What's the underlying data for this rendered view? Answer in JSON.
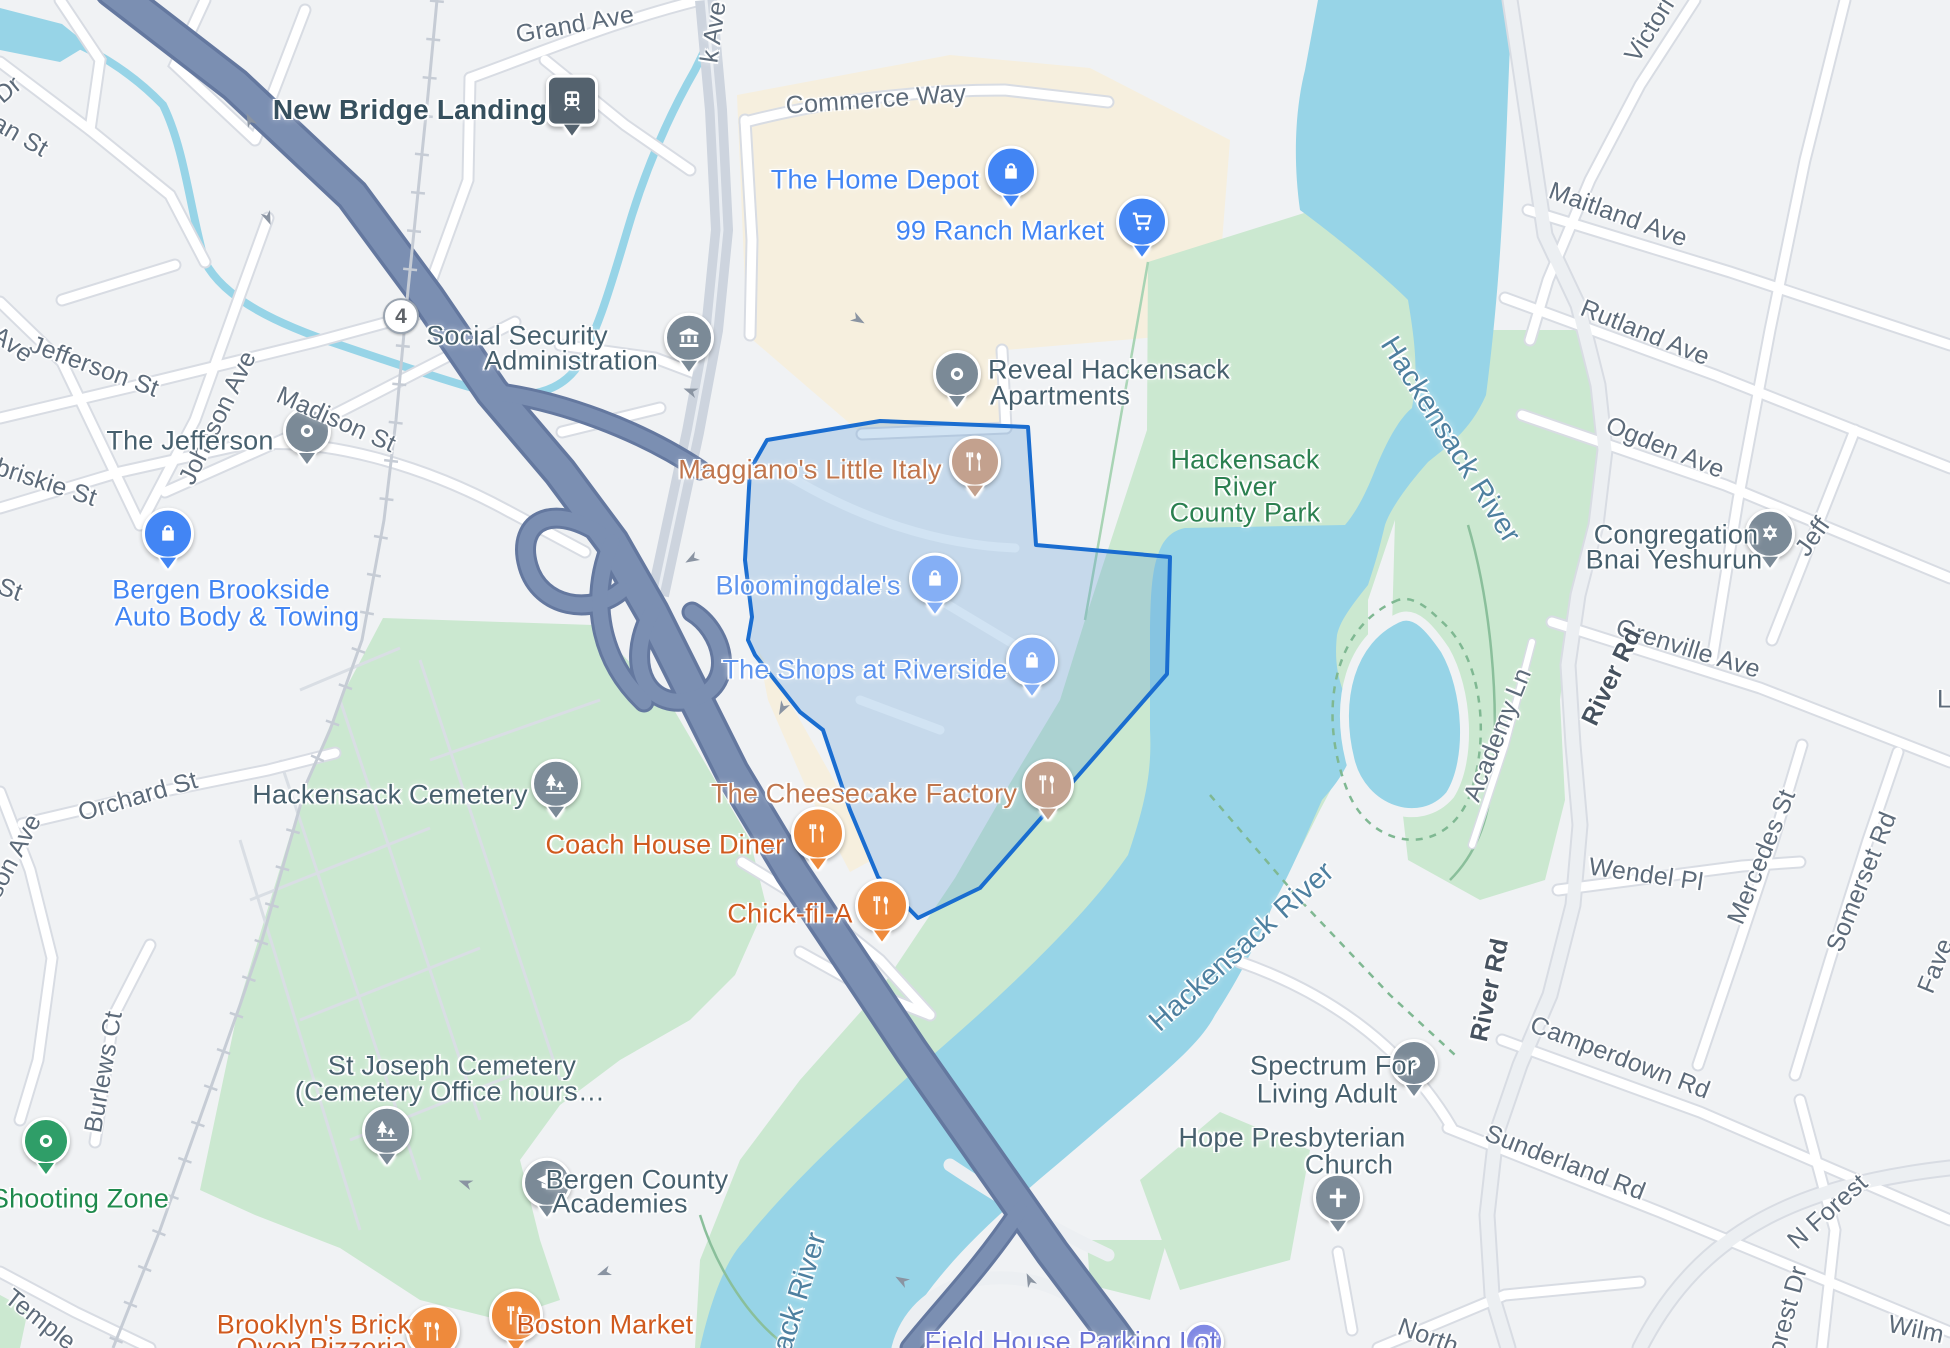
{
  "map_title": "Hackensack NJ area map with The Shops at Riverside region highlighted",
  "colors": {
    "land": "#f0f2f4",
    "commercial": "#f6efde",
    "park": "#cbe8d0",
    "water": "#97d4e7",
    "highway": "#7b8fb2",
    "highway_casing": "#64789f",
    "road_fill": "#ffffff",
    "road_casing": "#d8dce3",
    "selection_stroke": "#1a6dd0",
    "selection_fill": "rgba(91,155,213,0.28)",
    "shop_label": "#4285f4",
    "food_label": "#d05a1e",
    "park_label": "#2b8050",
    "water_label": "#4e80a0",
    "poi_label": "#47606e",
    "street_label": "#5d6b7a"
  },
  "labels": [
    {
      "name": "label-grand-ave",
      "text": "Grand Ave",
      "x": 575,
      "y": 25,
      "rot": -10,
      "cls": "street",
      "inter": false
    },
    {
      "name": "label-k-ave",
      "text": "k Ave",
      "x": 714,
      "y": 32,
      "rot": -82,
      "cls": "street",
      "inter": false
    },
    {
      "name": "label-commerce-way",
      "text": "Commerce Way",
      "x": 876,
      "y": 100,
      "rot": -4,
      "cls": "street",
      "inter": false
    },
    {
      "name": "label-dr-fragment",
      "text": "Dr",
      "x": 8,
      "y": 90,
      "rot": -40,
      "cls": "street",
      "inter": false
    },
    {
      "name": "label-an-st-fragment",
      "text": "an St",
      "x": 20,
      "y": 136,
      "rot": 30,
      "cls": "street",
      "inter": false
    },
    {
      "name": "label-madison-st",
      "text": "Madison St",
      "x": 336,
      "y": 420,
      "rot": 24,
      "cls": "street",
      "inter": false
    },
    {
      "name": "label-johnson-ave",
      "text": "Johnson Ave",
      "x": 218,
      "y": 418,
      "rot": -64,
      "cls": "street",
      "inter": false
    },
    {
      "name": "label-jefferson-st",
      "text": "Jefferson St",
      "x": 94,
      "y": 367,
      "rot": 20,
      "cls": "street",
      "inter": false
    },
    {
      "name": "label-ave-fragment",
      "text": "Ave",
      "x": 12,
      "y": 345,
      "rot": 35,
      "cls": "street",
      "inter": false
    },
    {
      "name": "label-briskie-st",
      "text": "briskie St",
      "x": 46,
      "y": 483,
      "rot": 18,
      "cls": "street",
      "inter": false
    },
    {
      "name": "label-st-fragment",
      "text": "St",
      "x": 10,
      "y": 590,
      "rot": 20,
      "cls": "street",
      "inter": false
    },
    {
      "name": "label-orchard-st",
      "text": "Orchard St",
      "x": 138,
      "y": 797,
      "rot": -16,
      "cls": "street",
      "inter": false
    },
    {
      "name": "label-son-ave-fragment",
      "text": "son Ave",
      "x": 14,
      "y": 856,
      "rot": -62,
      "cls": "street",
      "inter": false
    },
    {
      "name": "label-burlews-ct",
      "text": "Burlews Ct",
      "x": 104,
      "y": 1072,
      "rot": -80,
      "cls": "street",
      "inter": false
    },
    {
      "name": "label-temple-fragment",
      "text": "Temple",
      "x": 40,
      "y": 1320,
      "rot": 38,
      "cls": "street",
      "inter": false
    },
    {
      "name": "label-victoria",
      "text": "Victori",
      "x": 1650,
      "y": 30,
      "rot": -58,
      "cls": "street",
      "inter": false
    },
    {
      "name": "label-maitland-ave",
      "text": "Maitland Ave",
      "x": 1618,
      "y": 215,
      "rot": 20,
      "cls": "street",
      "inter": false
    },
    {
      "name": "label-rutland-ave",
      "text": "Rutland Ave",
      "x": 1645,
      "y": 333,
      "rot": 22,
      "cls": "street",
      "inter": false
    },
    {
      "name": "label-ogden-ave",
      "text": "Ogden Ave",
      "x": 1665,
      "y": 448,
      "rot": 22,
      "cls": "street",
      "inter": false
    },
    {
      "name": "label-jeff-fragment",
      "text": "Jeff",
      "x": 1813,
      "y": 537,
      "rot": -55,
      "cls": "street",
      "inter": false
    },
    {
      "name": "label-grenville-ave",
      "text": "Grenville Ave",
      "x": 1688,
      "y": 649,
      "rot": 17,
      "cls": "street",
      "inter": false
    },
    {
      "name": "label-river-rd-upper",
      "text": "River Rd",
      "x": 1612,
      "y": 677,
      "rot": -64,
      "cls": "street-bold",
      "inter": false
    },
    {
      "name": "label-academy-ln",
      "text": "Academy Ln",
      "x": 1498,
      "y": 735,
      "rot": -68,
      "cls": "street",
      "inter": false
    },
    {
      "name": "label-wendel-pl",
      "text": "Wendel Pl",
      "x": 1646,
      "y": 875,
      "rot": 8,
      "cls": "street",
      "inter": false
    },
    {
      "name": "label-mercedes-st",
      "text": "Mercedes St",
      "x": 1762,
      "y": 857,
      "rot": -68,
      "cls": "street",
      "inter": false
    },
    {
      "name": "label-somerset-rd",
      "text": "Somerset Rd",
      "x": 1862,
      "y": 882,
      "rot": -68,
      "cls": "street",
      "inter": false
    },
    {
      "name": "label-fave-fragment",
      "text": "Fave",
      "x": 1936,
      "y": 966,
      "rot": -68,
      "cls": "street",
      "inter": false
    },
    {
      "name": "label-river-rd-lower",
      "text": "River Rd",
      "x": 1490,
      "y": 990,
      "rot": -78,
      "cls": "street-bold",
      "inter": false
    },
    {
      "name": "label-camperdown-rd",
      "text": "Camperdown Rd",
      "x": 1620,
      "y": 1058,
      "rot": 21,
      "cls": "street",
      "inter": false
    },
    {
      "name": "label-sunderland-rd",
      "text": "Sunderland Rd",
      "x": 1565,
      "y": 1163,
      "rot": 21,
      "cls": "street",
      "inter": false
    },
    {
      "name": "label-n-forest",
      "text": "N Forest",
      "x": 1828,
      "y": 1212,
      "rot": -42,
      "cls": "street",
      "inter": false
    },
    {
      "name": "label-forest-dr",
      "text": "Forest Dr",
      "x": 1786,
      "y": 1318,
      "rot": -75,
      "cls": "street",
      "inter": false
    },
    {
      "name": "label-wilm-fragment",
      "text": "Wilm",
      "x": 1916,
      "y": 1330,
      "rot": 12,
      "cls": "street",
      "inter": false
    },
    {
      "name": "label-north-fragment",
      "text": "North",
      "x": 1428,
      "y": 1337,
      "rot": 20,
      "cls": "street",
      "inter": false
    },
    {
      "name": "label-l-fragment",
      "text": "L",
      "x": 1944,
      "y": 700,
      "rot": 0,
      "cls": "street",
      "inter": false
    },
    {
      "name": "label-new-bridge-landing",
      "text": "New Bridge Landing",
      "x": 410,
      "y": 110,
      "rot": 0,
      "cls": "transit",
      "inter": true
    },
    {
      "name": "label-social-security-1",
      "text": "Social Security",
      "x": 517,
      "y": 336,
      "rot": 0,
      "cls": "poi",
      "inter": true
    },
    {
      "name": "label-social-security-2",
      "text": "Administration",
      "x": 571,
      "y": 361,
      "rot": 0,
      "cls": "poi",
      "inter": true
    },
    {
      "name": "label-the-jefferson",
      "text": "The Jefferson",
      "x": 190,
      "y": 441,
      "rot": 0,
      "cls": "poi",
      "inter": true
    },
    {
      "name": "label-reveal-1",
      "text": "Reveal Hackensack",
      "x": 1109,
      "y": 370,
      "rot": 0,
      "cls": "poi",
      "inter": true
    },
    {
      "name": "label-reveal-2",
      "text": "Apartments",
      "x": 1060,
      "y": 396,
      "rot": 0,
      "cls": "poi",
      "inter": true
    },
    {
      "name": "label-hackensack-cemetery",
      "text": "Hackensack Cemetery",
      "x": 390,
      "y": 795,
      "rot": 0,
      "cls": "poi",
      "inter": true
    },
    {
      "name": "label-st-joseph-1",
      "text": "St Joseph Cemetery",
      "x": 452,
      "y": 1066,
      "rot": 0,
      "cls": "poi",
      "inter": true
    },
    {
      "name": "label-st-joseph-2",
      "text": "(Cemetery Office hours…",
      "x": 450,
      "y": 1092,
      "rot": 0,
      "cls": "poi",
      "inter": true
    },
    {
      "name": "label-bergen-academies-1",
      "text": "Bergen County",
      "x": 637,
      "y": 1180,
      "rot": 0,
      "cls": "poi",
      "inter": true
    },
    {
      "name": "label-bergen-academies-2",
      "text": "Academies",
      "x": 620,
      "y": 1204,
      "rot": 0,
      "cls": "poi",
      "inter": true
    },
    {
      "name": "label-spectrum-1",
      "text": "Spectrum For",
      "x": 1333,
      "y": 1066,
      "rot": 0,
      "cls": "poi",
      "inter": true
    },
    {
      "name": "label-spectrum-2",
      "text": "Living Adult",
      "x": 1327,
      "y": 1094,
      "rot": 0,
      "cls": "poi",
      "inter": true
    },
    {
      "name": "label-hope-church-1",
      "text": "Hope Presbyterian",
      "x": 1292,
      "y": 1138,
      "rot": 0,
      "cls": "poi",
      "inter": true
    },
    {
      "name": "label-hope-church-2",
      "text": "Church",
      "x": 1349,
      "y": 1165,
      "rot": 0,
      "cls": "poi",
      "inter": true
    },
    {
      "name": "label-congregation-1",
      "text": "Congregation",
      "x": 1676,
      "y": 535,
      "rot": 0,
      "cls": "poi",
      "inter": true
    },
    {
      "name": "label-congregation-2",
      "text": "Bnai Yeshurun",
      "x": 1674,
      "y": 560,
      "rot": 0,
      "cls": "poi",
      "inter": true
    },
    {
      "name": "label-home-depot",
      "text": "The Home Depot",
      "x": 875,
      "y": 180,
      "rot": 0,
      "cls": "shop",
      "inter": true
    },
    {
      "name": "label-99-ranch",
      "text": "99 Ranch Market",
      "x": 1000,
      "y": 231,
      "rot": 0,
      "cls": "shop",
      "inter": true
    },
    {
      "name": "label-bergen-brookside-1",
      "text": "Bergen Brookside",
      "x": 221,
      "y": 590,
      "rot": 0,
      "cls": "shop",
      "inter": true
    },
    {
      "name": "label-bergen-brookside-2",
      "text": "Auto Body & Towing",
      "x": 237,
      "y": 617,
      "rot": 0,
      "cls": "shop",
      "inter": true
    },
    {
      "name": "label-bloomingdales",
      "text": "Bloomingdale's",
      "x": 808,
      "y": 586,
      "rot": 0,
      "cls": "shop-light",
      "inter": true
    },
    {
      "name": "label-shops-riverside",
      "text": "The Shops at Riverside",
      "x": 865,
      "y": 670,
      "rot": 0,
      "cls": "shop-light",
      "inter": true
    },
    {
      "name": "label-maggianos",
      "text": "Maggiano's Little Italy",
      "x": 810,
      "y": 470,
      "rot": 0,
      "cls": "food-muted",
      "inter": true
    },
    {
      "name": "label-cheesecake",
      "text": "The Cheesecake Factory",
      "x": 864,
      "y": 794,
      "rot": 0,
      "cls": "food-muted",
      "inter": true
    },
    {
      "name": "label-coach-house",
      "text": "Coach House Diner",
      "x": 665,
      "y": 845,
      "rot": 0,
      "cls": "food",
      "inter": true
    },
    {
      "name": "label-chick-fil-a",
      "text": "Chick-fil-A",
      "x": 790,
      "y": 914,
      "rot": 0,
      "cls": "food",
      "inter": true
    },
    {
      "name": "label-boston-market",
      "text": "Boston Market",
      "x": 605,
      "y": 1325,
      "rot": 0,
      "cls": "food",
      "inter": true
    },
    {
      "name": "label-brooklyns-1",
      "text": "Brooklyn's Brick",
      "x": 314,
      "y": 1325,
      "rot": 0,
      "cls": "food",
      "inter": true
    },
    {
      "name": "label-brooklyns-2",
      "text": "Oven Pizzeria",
      "x": 322,
      "y": 1348,
      "rot": 0,
      "cls": "food",
      "inter": true
    },
    {
      "name": "label-county-park-1",
      "text": "Hackensack",
      "x": 1245,
      "y": 460,
      "rot": 0,
      "cls": "park",
      "inter": true
    },
    {
      "name": "label-county-park-2",
      "text": "River",
      "x": 1245,
      "y": 487,
      "rot": 0,
      "cls": "park",
      "inter": true
    },
    {
      "name": "label-county-park-3",
      "text": "County Park",
      "x": 1245,
      "y": 513,
      "rot": 0,
      "cls": "park",
      "inter": true
    },
    {
      "name": "label-shooting-zone",
      "text": "Shooting Zone",
      "x": 80,
      "y": 1199,
      "rot": 0,
      "cls": "shooting",
      "inter": true
    },
    {
      "name": "label-hackensack-river-1",
      "text": "Hackensack River",
      "x": 1450,
      "y": 440,
      "rot": 58,
      "cls": "water",
      "inter": false
    },
    {
      "name": "label-hackensack-river-2",
      "text": "Hackensack River",
      "x": 1242,
      "y": 947,
      "rot": -42,
      "cls": "water",
      "inter": false
    },
    {
      "name": "label-hackensack-river-3",
      "text": "ack River",
      "x": 800,
      "y": 1292,
      "rot": -73,
      "cls": "water",
      "inter": false
    },
    {
      "name": "label-field-house",
      "text": "Field House Parking Lot",
      "x": 1071,
      "y": 1342,
      "rot": 0,
      "cls": "parking",
      "inter": true
    }
  ],
  "pins": [
    {
      "name": "bergen-brookside-pin",
      "icon": "bag",
      "x": 168,
      "y": 543,
      "style": "blue",
      "size": 46
    },
    {
      "name": "home-depot-pin",
      "icon": "bag",
      "x": 1011,
      "y": 181,
      "style": "blue",
      "size": 46
    },
    {
      "name": "99-ranch-pin",
      "icon": "cart",
      "x": 1142,
      "y": 231,
      "style": "blue",
      "size": 46
    },
    {
      "name": "bloomingdales-pin",
      "icon": "bag",
      "x": 935,
      "y": 588,
      "style": "lightblue",
      "size": 46
    },
    {
      "name": "shops-riverside-pin",
      "icon": "bag",
      "x": 1032,
      "y": 670,
      "style": "lightblue",
      "size": 46
    },
    {
      "name": "maggianos-pin",
      "icon": "food",
      "x": 975,
      "y": 471,
      "style": "tan",
      "size": 46
    },
    {
      "name": "cheesecake-pin",
      "icon": "food",
      "x": 1048,
      "y": 794,
      "style": "tan",
      "size": 46
    },
    {
      "name": "coach-house-pin",
      "icon": "food",
      "x": 818,
      "y": 843,
      "style": "orange",
      "size": 48
    },
    {
      "name": "chick-fil-a-pin",
      "icon": "food",
      "x": 882,
      "y": 915,
      "style": "orange",
      "size": 48
    },
    {
      "name": "boston-market-pin",
      "icon": "food",
      "x": 516,
      "y": 1325,
      "style": "orange",
      "size": 48
    },
    {
      "name": "brooklyns-pin",
      "icon": "food",
      "x": 433,
      "y": 1341,
      "style": "orange",
      "size": 48
    },
    {
      "name": "social-security-pin",
      "icon": "bank",
      "x": 689,
      "y": 347,
      "style": "slate",
      "size": 44
    },
    {
      "name": "the-jefferson-pin",
      "icon": "dot",
      "x": 307,
      "y": 440,
      "style": "slate",
      "size": 42
    },
    {
      "name": "reveal-apartments-pin",
      "icon": "dot",
      "x": 957,
      "y": 383,
      "style": "slate",
      "size": 42
    },
    {
      "name": "spectrum-pin",
      "icon": "dot",
      "x": 1414,
      "y": 1072,
      "style": "slate",
      "size": 42
    },
    {
      "name": "congregation-pin",
      "icon": "star",
      "x": 1770,
      "y": 543,
      "style": "slate",
      "size": 44
    },
    {
      "name": "hope-church-pin",
      "icon": "cross",
      "x": 1338,
      "y": 1207,
      "style": "slate",
      "size": 44
    },
    {
      "name": "bergen-academies-pin",
      "icon": "grad",
      "x": 547,
      "y": 1192,
      "style": "slate",
      "size": 44
    },
    {
      "name": "hackensack-cemetery-pin",
      "icon": "tree",
      "x": 556,
      "y": 793,
      "style": "slate",
      "size": 44
    },
    {
      "name": "st-joseph-cemetery-pin",
      "icon": "tree",
      "x": 387,
      "y": 1140,
      "style": "slate",
      "size": 44
    },
    {
      "name": "shooting-zone-pin",
      "icon": "dot",
      "x": 46,
      "y": 1150,
      "style": "green",
      "size": 42
    },
    {
      "name": "new-bridge-landing-station-icon",
      "icon": "train",
      "x": 572,
      "y": 110,
      "style": "train",
      "size": 46
    },
    {
      "name": "field-house-parking-pin",
      "icon": "pletter",
      "x": 1204,
      "y": 1345,
      "style": "parking",
      "size": 34
    },
    {
      "name": "route-4-shield",
      "icon": "route4",
      "x": 401,
      "y": 319,
      "style": "shield",
      "size": 32
    }
  ]
}
